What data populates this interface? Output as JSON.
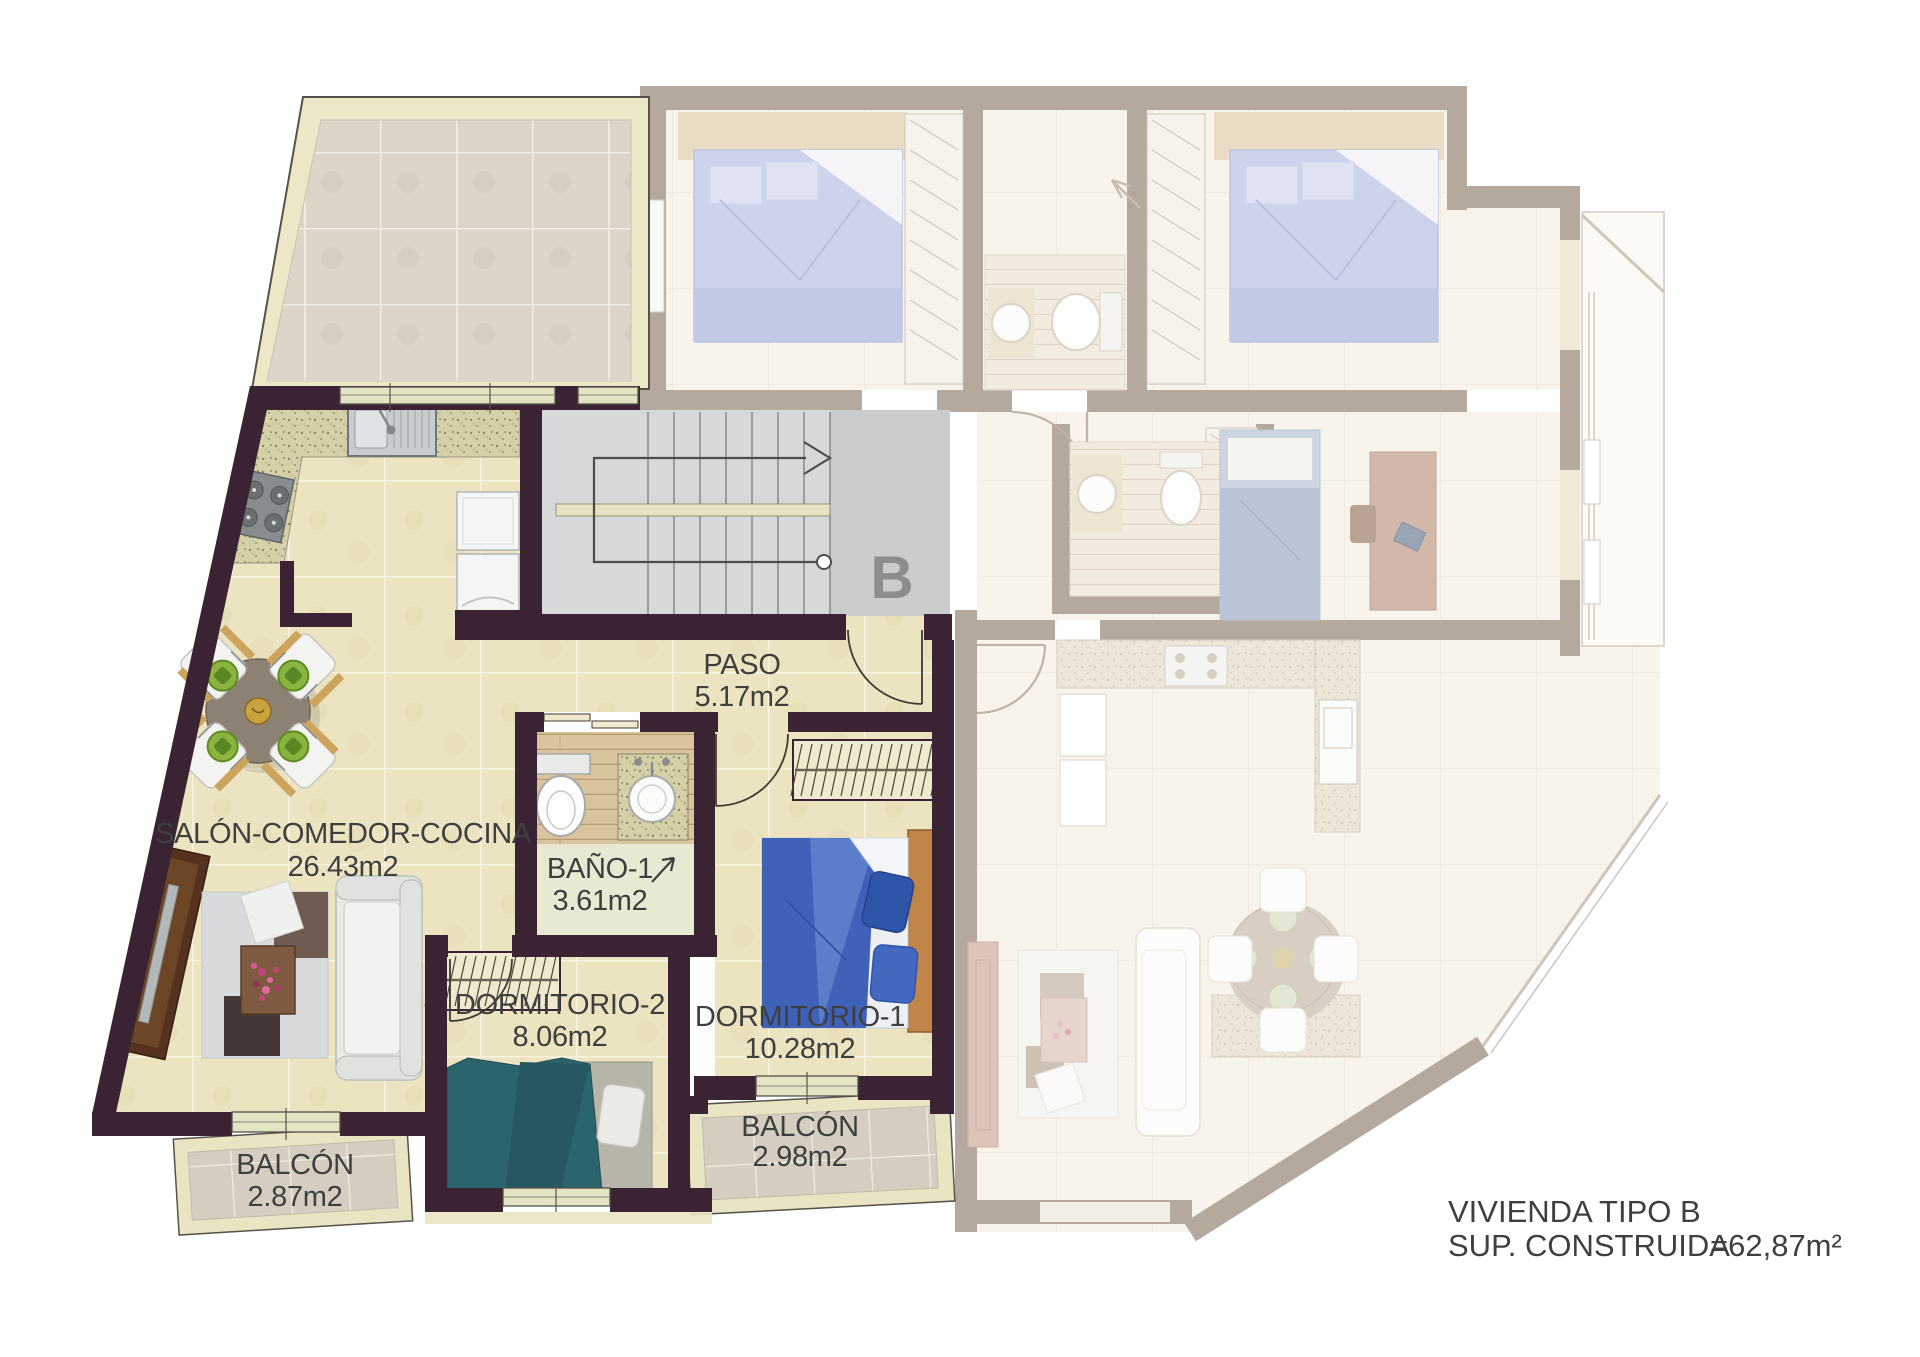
{
  "plan": {
    "stair_letter": "B",
    "rooms": {
      "salon": {
        "name": "SALÓN-COMEDOR-COCINA",
        "area": "26.43m2"
      },
      "paso": {
        "name": "PASO",
        "area": "5.17m2"
      },
      "bano": {
        "name": "BAÑO-1",
        "area": "3.61m2"
      },
      "dormitorio2": {
        "name": "DORMITORIO-2",
        "area": "8.06m2"
      },
      "dormitorio1": {
        "name": "DORMITORIO-1",
        "area": "10.28m2"
      },
      "balcon_salon": {
        "name": "BALCÓN",
        "area": "2.87m2"
      },
      "balcon_dormitorio": {
        "name": "BALCÓN",
        "area": "2.98m2"
      }
    },
    "footer": {
      "line1": "VIVIENDA TIPO B",
      "sup_label": "SUP. CONSTRUIDA",
      "sup_value": "=62,87m²"
    },
    "colors": {
      "wall": "#3A2433",
      "faded_wall": "#B5A89D",
      "floor_tile": "#ECE3C0",
      "terrace_tile": "#DCD5C8",
      "balcony_tile": "#D5CEC0",
      "stair_floor": "#D6D8D9",
      "granite": "#D6D0A9",
      "text": "#3F3F3F",
      "stair_letter": "#8D8D8D",
      "bed_dorm1": "#3F62B8",
      "bed_dorm2": "#2C646E",
      "faded_bed": "#CDD3EA"
    }
  }
}
